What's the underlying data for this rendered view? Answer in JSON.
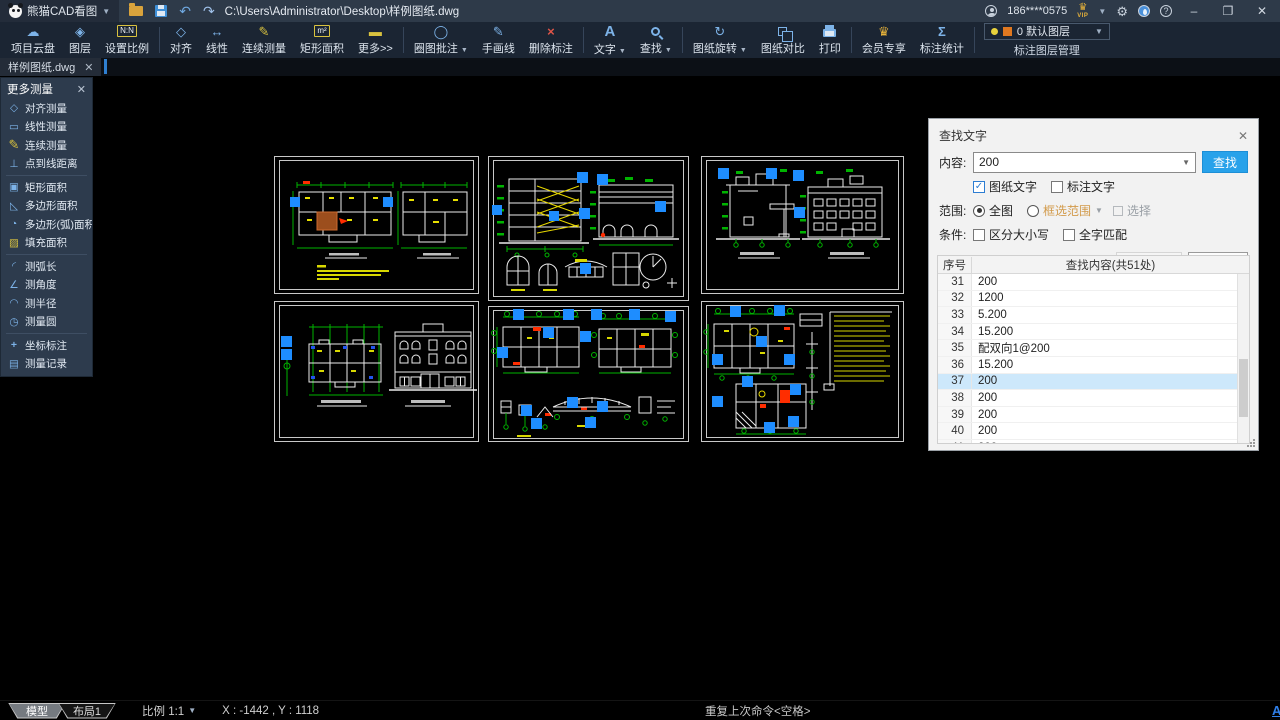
{
  "titlebar": {
    "app_name": "熊猫CAD看图",
    "file_path": "C:\\Users\\Administrator\\Desktop\\样例图纸.dwg",
    "account": "186****0575",
    "vip_label": "VIP"
  },
  "toolbar": {
    "groups": [
      {
        "items": [
          {
            "name": "cloud",
            "label": "项目云盘",
            "icon": "cloud-icon"
          },
          {
            "name": "layers",
            "label": "图层",
            "icon": "layers-icon"
          },
          {
            "name": "set-scale",
            "label": "设置比例",
            "icon": "scale-ratio-icon"
          }
        ]
      },
      {
        "items": [
          {
            "name": "align",
            "label": "对齐",
            "icon": "align-icon"
          },
          {
            "name": "linear",
            "label": "线性",
            "icon": "linear-icon"
          },
          {
            "name": "continuous-measure",
            "label": "连续测量",
            "icon": "continuous-measure-icon"
          },
          {
            "name": "rect-area",
            "label": "矩形面积",
            "icon": "rect-area-icon"
          },
          {
            "name": "more",
            "label": "更多>>",
            "icon": "more-icon"
          }
        ]
      },
      {
        "items": [
          {
            "name": "circle-annotate",
            "label": "圈图批注",
            "icon": "circle-annotate-icon",
            "dropdown": true
          },
          {
            "name": "freehand",
            "label": "手画线",
            "icon": "freehand-icon"
          },
          {
            "name": "delete-annotation",
            "label": "删除标注",
            "icon": "delete-annotation-icon"
          }
        ]
      },
      {
        "items": [
          {
            "name": "text",
            "label": "文字",
            "icon": "text-icon",
            "dropdown": true
          },
          {
            "name": "find",
            "label": "查找",
            "icon": "find-icon",
            "dropdown": true
          }
        ]
      },
      {
        "items": [
          {
            "name": "rotate",
            "label": "图纸旋转",
            "icon": "rotate-icon",
            "dropdown": true
          },
          {
            "name": "compare",
            "label": "图纸对比",
            "icon": "compare-icon"
          },
          {
            "name": "print",
            "label": "打印",
            "icon": "print-icon"
          }
        ]
      },
      {
        "items": [
          {
            "name": "vip",
            "label": "会员专享",
            "icon": "vip-icon"
          },
          {
            "name": "stats",
            "label": "标注统计",
            "icon": "stats-icon"
          }
        ]
      }
    ],
    "layer": {
      "current": "0 默认图层",
      "manage_label": "标注图层管理"
    }
  },
  "tabbar": {
    "active_tab": "样例图纸.dwg"
  },
  "measure_panel": {
    "title": "更多测量",
    "groups": [
      [
        {
          "name": "align-measure",
          "label": "对齐测量",
          "icon": "align-measure-icon"
        },
        {
          "name": "linear-measure",
          "label": "线性测量",
          "icon": "linear-measure-icon"
        },
        {
          "name": "continuous-measure",
          "label": "连续测量",
          "icon": "continuous-measure-icon"
        },
        {
          "name": "point-to-line",
          "label": "点到线距离",
          "icon": "point-line-icon"
        }
      ],
      [
        {
          "name": "rect-area",
          "label": "矩形面积",
          "icon": "rect-area2-icon"
        },
        {
          "name": "polygon-area",
          "label": "多边形面积",
          "icon": "polygon-area-icon"
        },
        {
          "name": "polygon-arc-area",
          "label": "多边形(弧)面积",
          "icon": "polygon-arc-icon"
        },
        {
          "name": "fill-area",
          "label": "填充面积",
          "icon": "fill-area-icon"
        }
      ],
      [
        {
          "name": "arc-length",
          "label": "测弧长",
          "icon": "arc-length-icon"
        },
        {
          "name": "angle",
          "label": "测角度",
          "icon": "angle-icon"
        },
        {
          "name": "radius",
          "label": "测半径",
          "icon": "radius-icon"
        },
        {
          "name": "circle",
          "label": "测量圆",
          "icon": "circle-measure-icon"
        }
      ],
      [
        {
          "name": "coordinate",
          "label": "坐标标注",
          "icon": "coordinate-icon"
        },
        {
          "name": "record",
          "label": "测量记录",
          "icon": "record-icon"
        }
      ]
    ]
  },
  "find_dialog": {
    "title": "查找文字",
    "content_label": "内容:",
    "content_value": "200",
    "find_button": "查找",
    "cb_drawing_text": "图纸文字",
    "cb_annotation_text": "标注文字",
    "scope_label": "范围:",
    "scope_all": "全图",
    "scope_box": "框选范围",
    "select_label": "选择",
    "condition_label": "条件:",
    "cb_case": "区分大小写",
    "cb_whole": "全字匹配",
    "cb_lock_zoom": "锁定缩放比例",
    "export_button": "导出结果",
    "next_button": "下一项",
    "table": {
      "col_seq": "序号",
      "col_content": "查找内容(共51处)",
      "selected_seq": "37",
      "rows": [
        {
          "seq": "31",
          "text": "200"
        },
        {
          "seq": "32",
          "text": "1200"
        },
        {
          "seq": "33",
          "text": "5.200"
        },
        {
          "seq": "34",
          "text": "15.200"
        },
        {
          "seq": "35",
          "text": "配双向1@200"
        },
        {
          "seq": "36",
          "text": "15.200"
        },
        {
          "seq": "37",
          "text": "200"
        },
        {
          "seq": "38",
          "text": "200"
        },
        {
          "seq": "39",
          "text": "200"
        },
        {
          "seq": "40",
          "text": "200"
        },
        {
          "seq": "41",
          "text": "200"
        }
      ]
    }
  },
  "statusbar": {
    "model_tab": "模型",
    "layout_tab": "布局1",
    "scale": "比例 1:1",
    "coordinates": "X : -1442 , Y : 1118",
    "command_hint": "重复上次命令<空格>",
    "ai_label": "AI"
  }
}
